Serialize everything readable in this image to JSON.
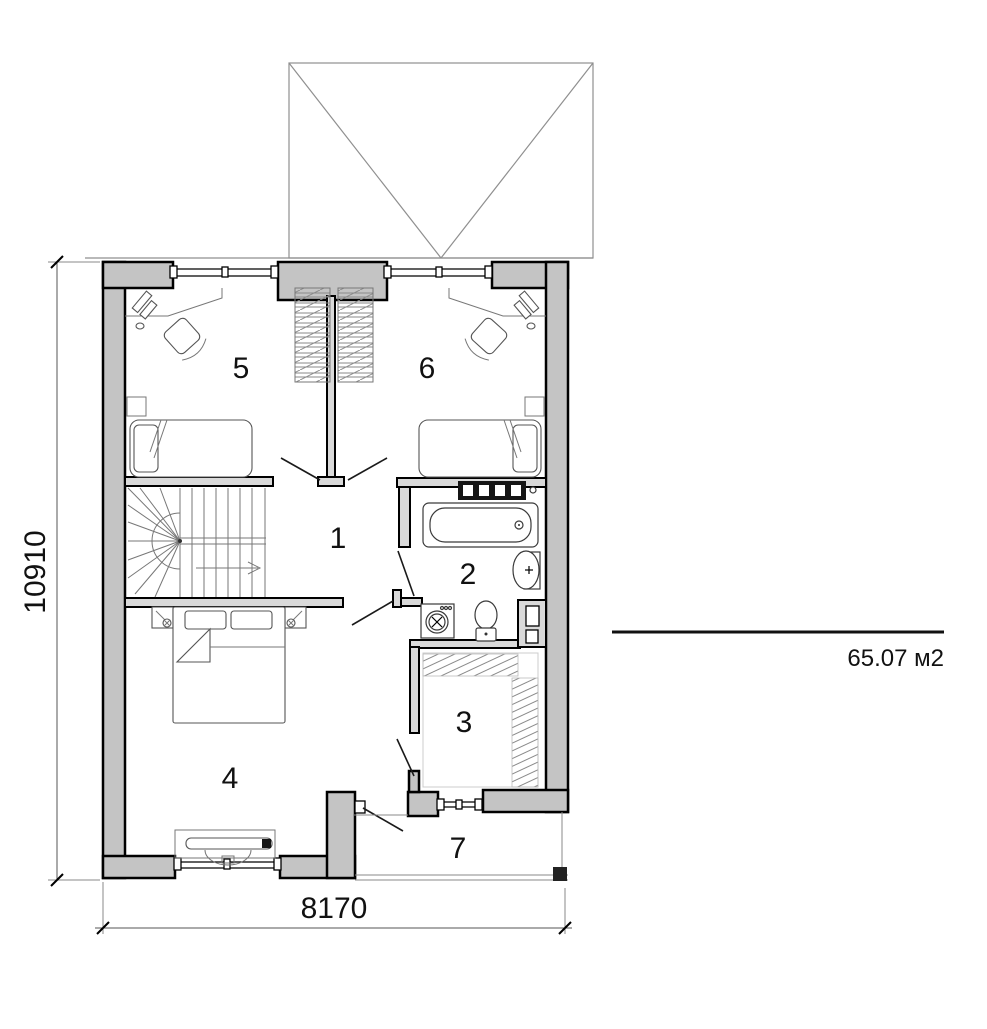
{
  "plan": {
    "rooms": [
      {
        "label": "1"
      },
      {
        "label": "2"
      },
      {
        "label": "3"
      },
      {
        "label": "4"
      },
      {
        "label": "5"
      },
      {
        "label": "6"
      },
      {
        "label": "7"
      }
    ],
    "dimensions": {
      "height": "10910",
      "width": "8170"
    },
    "area_label": "65.07 м2",
    "colors": {
      "wall_fill": "#c4c4c4",
      "wall_outline": "#000000",
      "interior_wall_fill": "#d9d9d9",
      "roof_line": "#8f8f8f",
      "furniture_line": "#555555",
      "text": "#111111",
      "background": "#ffffff"
    }
  }
}
